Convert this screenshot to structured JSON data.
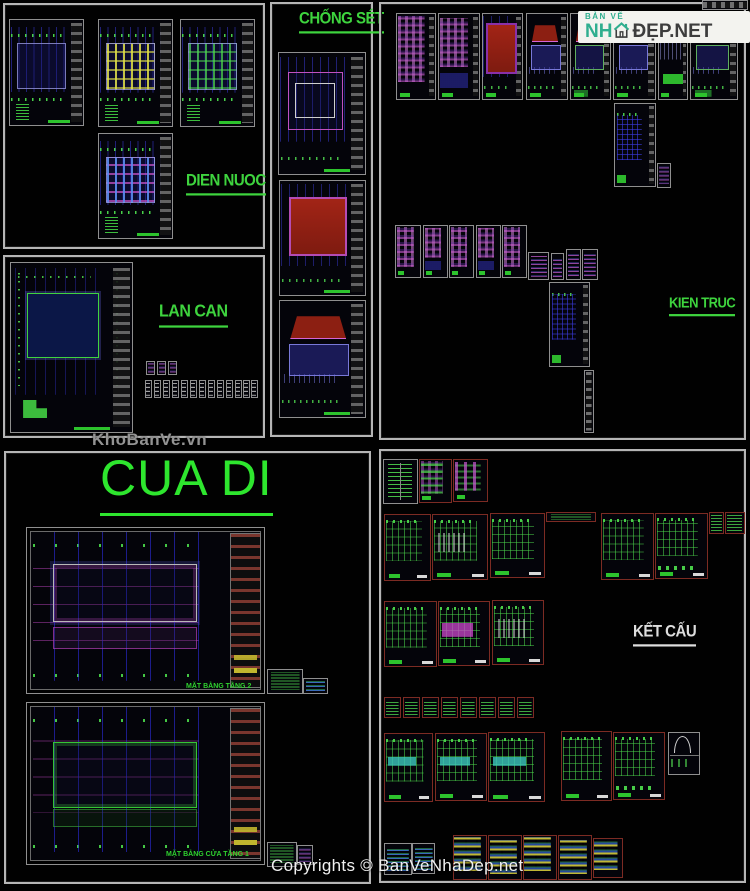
{
  "page": {
    "width": 750,
    "height": 891,
    "background": "#010101"
  },
  "branding": {
    "watermark": "KhoBanVe.vn",
    "copyright": "Copyrights © BanVeNhaDep.net",
    "logo": {
      "tagline": "BẢN VẼ",
      "word_green": "NH",
      "word_dark": "ĐẸP.NET",
      "icon": "house-icon",
      "background": "#f3f3ef",
      "green": "#2fae8f",
      "dark": "#3d3d3d"
    }
  },
  "colors": {
    "frame_border": "#b5b5b5",
    "sheet_border_gray": "#8f8f8f",
    "sheet_border_red": "#7c2b23",
    "accent_green": "#2ecc2e",
    "grid_blue": "#3c3ce6",
    "magenta": "#c455c4",
    "roof_red": "#8c1f12",
    "yellow": "#d6ca32",
    "label_green": "#3ed43e",
    "label_white": "#dedede"
  },
  "sections": [
    {
      "id": "dien-nuoc",
      "label": "DIEN NUOC",
      "color": "#3ed43e",
      "frame": [
        3,
        3,
        262,
        246
      ],
      "label_pos": [
        186,
        172
      ],
      "font": 15
    },
    {
      "id": "lan-can",
      "label": "LAN CAN",
      "color": "#3ed43e",
      "frame": [
        3,
        255,
        262,
        183
      ],
      "label_pos": [
        159,
        303
      ],
      "font": 16
    },
    {
      "id": "chong-set",
      "label": "CHỐNG SÉT",
      "color": "#3ed43e",
      "frame": [
        270,
        2,
        103,
        435
      ],
      "label_pos": [
        299,
        10
      ],
      "font": 15
    },
    {
      "id": "kien-truc",
      "label": "KIEN TRUC",
      "color": "#3ed43e",
      "frame": [
        379,
        2,
        367,
        438
      ],
      "label_pos": [
        669,
        295
      ],
      "font": 13
    },
    {
      "id": "cua-di",
      "label": "CUA DI",
      "color": "#2ee62e",
      "frame": [
        4,
        451,
        367,
        433
      ],
      "label_pos": [
        100,
        453
      ],
      "font": 50
    },
    {
      "id": "ket-cau",
      "label": "KẾT CẤU",
      "color": "#dedede",
      "frame": [
        379,
        449,
        367,
        434
      ],
      "label_pos": [
        633,
        623
      ],
      "font": 15
    }
  ],
  "captions": [
    {
      "text": "MẶT BẰNG TẦNG 2",
      "x": 186,
      "y": 683
    },
    {
      "text": "MẶT BẰNG CỬA TẦNG 1",
      "x": 166,
      "y": 851
    }
  ],
  "sheets": [
    [
      702,
      0,
      46,
      10,
      "p-striph",
      0,
      0
    ],
    [
      9,
      19,
      75,
      107,
      "p-dn",
      1,
      2
    ],
    [
      98,
      19,
      75,
      108,
      "p-dn v-y",
      1,
      2
    ],
    [
      180,
      19,
      75,
      108,
      "p-dn v-g",
      1,
      2
    ],
    [
      98,
      133,
      75,
      106,
      "p-dn v-m",
      1,
      2
    ],
    [
      10,
      262,
      123,
      171,
      "p-lancan",
      1,
      2
    ],
    [
      146,
      361,
      9,
      14,
      "p-thumbm",
      0,
      0
    ],
    [
      157,
      361,
      9,
      14,
      "p-thumbm",
      0,
      0
    ],
    [
      168,
      361,
      9,
      14,
      "p-thumbm",
      0,
      0
    ],
    [
      145,
      380,
      7,
      18,
      "p-thumbw",
      0,
      0
    ],
    [
      154,
      380,
      7,
      18,
      "p-thumbw",
      0,
      0
    ],
    [
      163,
      380,
      7,
      18,
      "p-thumbw",
      0,
      0
    ],
    [
      172,
      380,
      7,
      18,
      "p-thumbw",
      0,
      0
    ],
    [
      181,
      380,
      7,
      18,
      "p-thumbw",
      0,
      0
    ],
    [
      190,
      380,
      7,
      18,
      "p-thumbw",
      0,
      0
    ],
    [
      199,
      380,
      7,
      18,
      "p-thumbw",
      0,
      0
    ],
    [
      208,
      380,
      7,
      18,
      "p-thumbw",
      0,
      0
    ],
    [
      217,
      380,
      7,
      18,
      "p-thumbw",
      0,
      0
    ],
    [
      226,
      380,
      7,
      18,
      "p-thumbw",
      0,
      0
    ],
    [
      235,
      380,
      7,
      18,
      "p-thumbw",
      0,
      0
    ],
    [
      243,
      380,
      7,
      18,
      "p-thumbw",
      0,
      0
    ],
    [
      251,
      380,
      7,
      18,
      "p-thumbw",
      0,
      0
    ],
    [
      278,
      52,
      88,
      123,
      "p-cs1",
      1,
      2
    ],
    [
      279,
      180,
      87,
      116,
      "p-roof",
      1,
      2
    ],
    [
      279,
      300,
      87,
      118,
      "p-temple",
      1,
      2
    ],
    [
      396,
      13,
      40,
      87,
      "p-mag",
      1,
      1
    ],
    [
      438,
      13,
      42,
      87,
      "p-mag v2",
      1,
      1
    ],
    [
      482,
      13,
      41,
      87,
      "p-roof v2",
      1,
      1
    ],
    [
      526,
      13,
      42,
      87,
      "p-temple",
      1,
      1
    ],
    [
      570,
      13,
      41,
      87,
      "p-temple v2",
      1,
      1
    ],
    [
      613,
      13,
      43,
      87,
      "p-temple",
      1,
      1
    ],
    [
      658,
      13,
      30,
      87,
      "p-elevg",
      1,
      1
    ],
    [
      690,
      13,
      48,
      87,
      "p-temple v2",
      1,
      1
    ],
    [
      614,
      103,
      42,
      84,
      "p-planblue",
      1,
      0
    ],
    [
      657,
      163,
      14,
      25,
      "p-thumbm",
      0,
      0
    ],
    [
      395,
      225,
      26,
      53,
      "p-mag",
      0,
      1
    ],
    [
      423,
      225,
      25,
      53,
      "p-mag v2",
      0,
      1
    ],
    [
      449,
      225,
      25,
      53,
      "p-mag",
      0,
      1
    ],
    [
      476,
      225,
      25,
      53,
      "p-mag v2",
      0,
      1
    ],
    [
      502,
      225,
      25,
      53,
      "p-mag",
      0,
      1
    ],
    [
      528,
      252,
      21,
      28,
      "p-thumbm",
      0,
      0
    ],
    [
      551,
      253,
      13,
      27,
      "p-thumbm",
      0,
      0
    ],
    [
      566,
      249,
      15,
      31,
      "p-thumbm",
      0,
      0
    ],
    [
      582,
      249,
      16,
      31,
      "p-thumbm",
      0,
      0
    ],
    [
      549,
      282,
      41,
      85,
      "p-planblue v2",
      1,
      0
    ],
    [
      584,
      370,
      10,
      63,
      "p-strip",
      0,
      0
    ],
    [
      26,
      527,
      239,
      167,
      "p-cua",
      2,
      0
    ],
    [
      267,
      669,
      36,
      25,
      "p-thumbg",
      0,
      0
    ],
    [
      303,
      678,
      25,
      16,
      "p-thumbb",
      0,
      0
    ],
    [
      26,
      702,
      239,
      163,
      "p-cua v2",
      2,
      0
    ],
    [
      267,
      842,
      30,
      25,
      "p-thumbg",
      0,
      0
    ],
    [
      297,
      845,
      16,
      20,
      "p-thumbm",
      0,
      0
    ],
    [
      383,
      459,
      35,
      45,
      "p-tableg",
      0,
      0
    ],
    [
      419,
      459,
      33,
      44,
      "p-mag v-g b-r",
      0,
      1
    ],
    [
      453,
      459,
      35,
      43,
      "p-colmag b-r",
      0,
      1
    ],
    [
      384,
      514,
      47,
      67,
      "p-gridg b-r",
      0,
      1
    ],
    [
      432,
      514,
      56,
      66,
      "p-gridg v-b b-r",
      0,
      1
    ],
    [
      490,
      513,
      55,
      65,
      "p-gridg b-r",
      0,
      1
    ],
    [
      546,
      512,
      50,
      10,
      "p-thumbg b-r",
      0,
      0
    ],
    [
      601,
      513,
      53,
      67,
      "p-gridg b-r",
      0,
      1
    ],
    [
      655,
      513,
      53,
      66,
      "p-gridg v-d b-r",
      0,
      1
    ],
    [
      709,
      512,
      15,
      22,
      "p-thumbg b-r",
      0,
      0
    ],
    [
      725,
      512,
      20,
      22,
      "p-thumbg b-r",
      0,
      0
    ],
    [
      384,
      601,
      53,
      66,
      "p-gridg b-r",
      0,
      1
    ],
    [
      438,
      601,
      52,
      65,
      "p-gridg v-m b-r",
      0,
      1
    ],
    [
      492,
      600,
      52,
      65,
      "p-gridg v-b b-r",
      0,
      1
    ],
    [
      384,
      697,
      17,
      21,
      "p-thumbg b-r",
      0,
      0
    ],
    [
      403,
      697,
      17,
      21,
      "p-thumbg b-r",
      0,
      0
    ],
    [
      422,
      697,
      17,
      21,
      "p-thumbg b-r",
      0,
      0
    ],
    [
      441,
      697,
      17,
      21,
      "p-thumbg b-r",
      0,
      0
    ],
    [
      460,
      697,
      17,
      21,
      "p-thumbg b-r",
      0,
      0
    ],
    [
      479,
      697,
      17,
      21,
      "p-thumbg b-r",
      0,
      0
    ],
    [
      498,
      697,
      17,
      21,
      "p-thumbg b-r",
      0,
      0
    ],
    [
      517,
      697,
      17,
      21,
      "p-thumbg b-r",
      0,
      0
    ],
    [
      384,
      733,
      49,
      69,
      "p-gridg v-c b-r",
      0,
      1
    ],
    [
      435,
      733,
      52,
      68,
      "p-gridg v-c b-r",
      0,
      1
    ],
    [
      488,
      732,
      57,
      70,
      "p-gridg v-c b-r",
      0,
      1
    ],
    [
      561,
      731,
      51,
      70,
      "p-gridg b-r",
      0,
      1
    ],
    [
      613,
      732,
      52,
      68,
      "p-gridg v-d b-r",
      0,
      1
    ],
    [
      668,
      732,
      32,
      43,
      "p-arc",
      0,
      0
    ],
    [
      384,
      843,
      28,
      32,
      "p-thumbb",
      0,
      0
    ],
    [
      412,
      843,
      23,
      31,
      "p-thumbb",
      0,
      0
    ],
    [
      453,
      835,
      34,
      45,
      "p-yellow b-r",
      0,
      0
    ],
    [
      488,
      835,
      34,
      45,
      "p-yellow v2 b-r",
      0,
      0
    ],
    [
      523,
      835,
      34,
      45,
      "p-yellow b-r",
      0,
      0
    ],
    [
      558,
      835,
      34,
      45,
      "p-yellow v2 b-r",
      0,
      0
    ],
    [
      593,
      838,
      30,
      40,
      "p-yellow b-r",
      0,
      0
    ]
  ]
}
